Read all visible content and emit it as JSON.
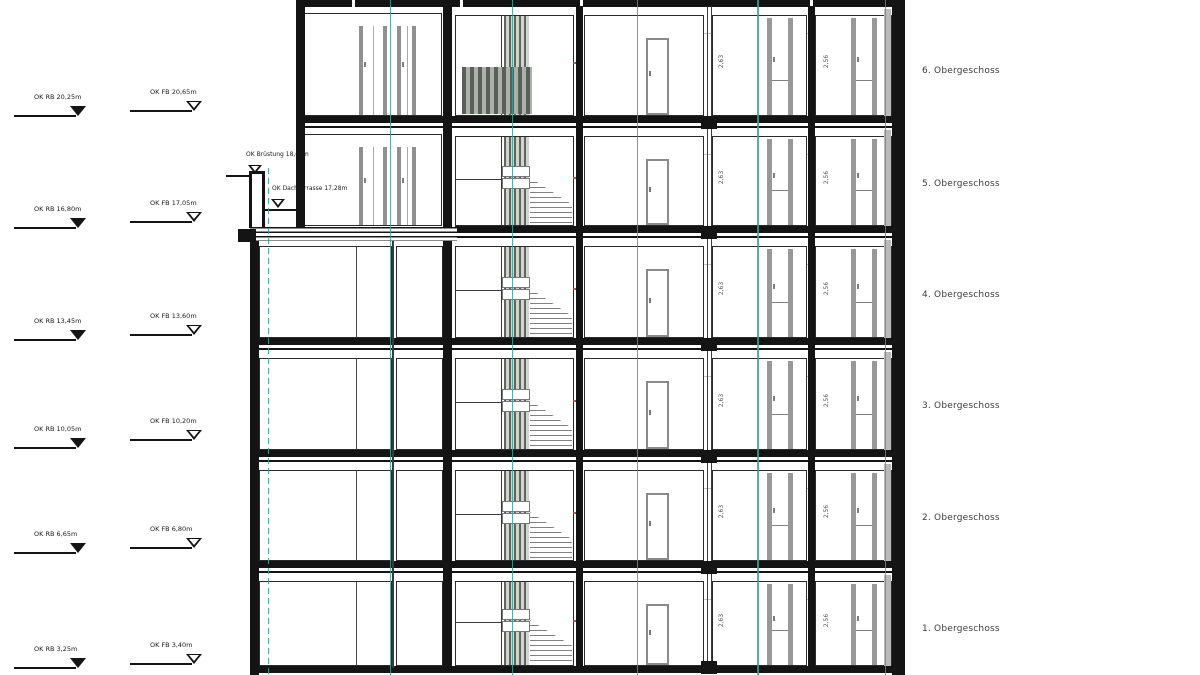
{
  "drawing": {
    "floor_labels": [
      "6. Obergeschoss",
      "5. Obergeschoss",
      "4. Obergeschoss",
      "3. Obergeschoss",
      "2. Obergeschoss",
      "1. Obergeschoss"
    ],
    "levels": [
      {
        "rb": "OK RB 20,25m",
        "fb": "OK FB 20,65m"
      },
      {
        "rb": "OK RB 16,80m",
        "fb": "OK FB 17,05m"
      },
      {
        "rb": "OK RB 13,45m",
        "fb": "OK FB 13,60m"
      },
      {
        "rb": "OK RB 10,05m",
        "fb": "OK FB 10,20m"
      },
      {
        "rb": "OK RB 6,65m",
        "fb": "OK FB 6,80m"
      },
      {
        "rb": "OK RB 3,25m",
        "fb": "OK FB 3,40m"
      }
    ],
    "terrace": {
      "bruestung": "OK Brüstung 18,60m",
      "dachterrasse": "OK Dachterrasse 17,28m"
    },
    "dims": {
      "room_d": "2,63",
      "room_e": "2,56"
    },
    "colors": {
      "axis_teal": "#3e9e93",
      "mark_red": "#c1504c",
      "wall_black": "#141414",
      "detail_gray": "#8a8a8a"
    }
  }
}
